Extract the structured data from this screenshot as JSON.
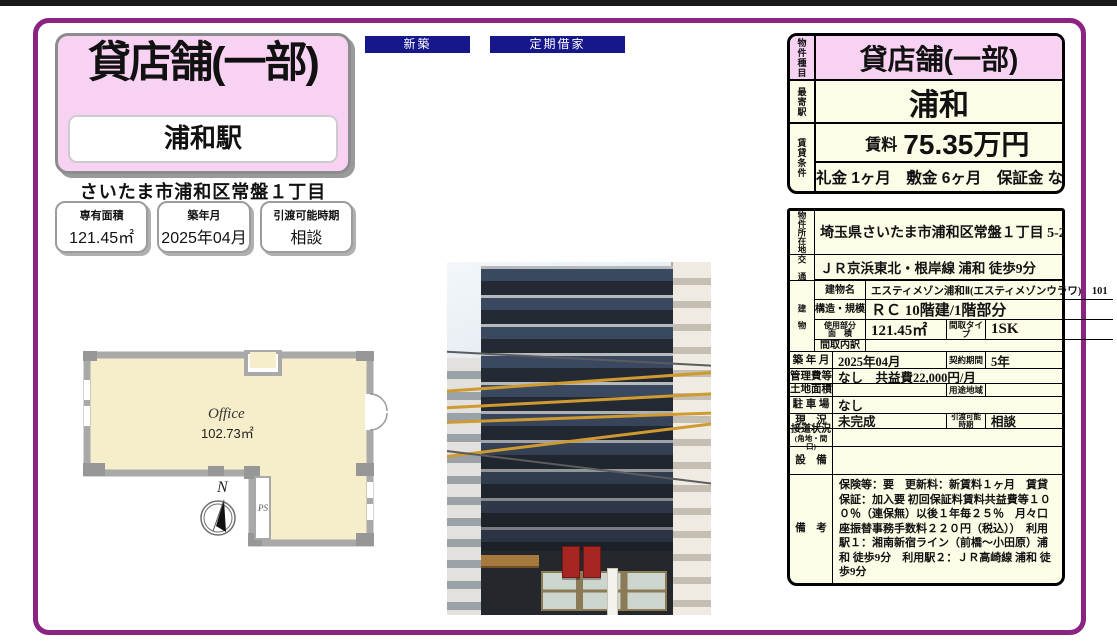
{
  "colors": {
    "frame_purple": "#8b2383",
    "accent_pink": "#f8d2f3",
    "cream": "#fdfce6",
    "badge_navy": "#17178c"
  },
  "badges": {
    "new_build": "新築",
    "fixed_term": "定期借家"
  },
  "hero": {
    "property_type": "貸店舗(一部)",
    "station": "浦和駅",
    "address": "さいたま市浦和区常盤１丁目"
  },
  "stats": [
    {
      "label": "専有面積",
      "value": "121.45㎡"
    },
    {
      "label": "築年月",
      "value": "2025年04月"
    },
    {
      "label": "引渡可能時期",
      "value": "相談"
    }
  ],
  "floorplan": {
    "room": "Office",
    "area": "102.73㎡",
    "ps": "PS",
    "north": "N"
  },
  "summary": {
    "type_label": "物件種目",
    "type_value": "貸店舗(一部)",
    "station_label": "最寄駅",
    "station_value": "浦和",
    "terms_label": "賃貸条件",
    "rent_label": "賃料",
    "rent_value": "75.35万円",
    "terms_line": "礼金 1ヶ月　敷金 6ヶ月　保証金 なし"
  },
  "details": {
    "location_label": "物件所在地",
    "location": "埼玉県さいたま市浦和区常盤１丁目 5-2",
    "access_label": "交　通",
    "access": "ＪＲ京浜東北・根岸線 浦和 徒歩9分",
    "building_label": "建　物",
    "building_name_label": "建物名",
    "building_name": "エスティメゾン浦和Ⅱ(エスティメゾンウラワ)　101",
    "structure_label": "構造・規模",
    "structure": "ＲＣ 10階建/1階部分",
    "floor_area_label_1": "使用部分",
    "floor_area_label_2": "面　積",
    "floor_area": "121.45㎡",
    "layout_type_label": "間取タイプ",
    "layout_type": "1SK",
    "layout_detail_label": "間取内訳",
    "built_label": "築 年 月",
    "built": "2025年04月",
    "contract_label": "契約期間",
    "contract": "5年",
    "mgmt_label": "管理費等",
    "mgmt": "なし　共益費22,000円/月",
    "land_label": "土地面積",
    "zoning_label": "用途地域",
    "parking_label": "駐 車 場",
    "parking": "なし",
    "status_label": "現　況",
    "status": "未完成",
    "handover_label_1": "引渡可能",
    "handover_label_2": "時期",
    "handover": "相談",
    "road_label_1": "接道状況",
    "road_label_2": "(角地・間口)",
    "equipment_label": "設　備",
    "remarks_label": "備　考",
    "remarks": "保険等：要　更新料：新賃料１ヶ月　賃貸保証：加入要 初回保証料賃料共益費等１００％（連保無）以後１年毎２５％　月々口座振替事務手数料２２０円（税込））　利用駅１：湘南新宿ライン（前橋～小田原）浦和 徒歩9分　利用駅２：ＪＲ高崎線 浦和 徒歩9分"
  }
}
